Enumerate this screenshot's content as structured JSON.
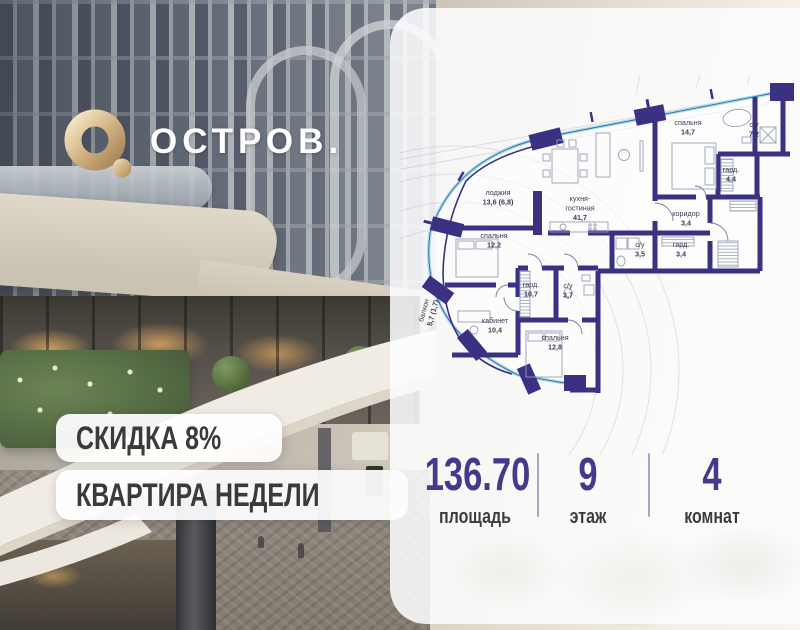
{
  "logo": {
    "brand": "ОСТРОВ.",
    "mark": "О."
  },
  "badges": {
    "discount": "СКИДКА 8%",
    "weekly": "КВАРТИРА НЕДЕЛИ"
  },
  "stats": {
    "area": {
      "value": "136.70",
      "label": "площадь"
    },
    "floor": {
      "value": "9",
      "label": "этаж"
    },
    "rooms": {
      "value": "4",
      "label": "комнат"
    }
  },
  "floor_plan": {
    "rooms": [
      {
        "id": "bedroom-1",
        "name": "спальня",
        "area": "14,7"
      },
      {
        "id": "bath-1",
        "name": "с/у",
        "area": "7,2"
      },
      {
        "id": "wardrobe-1",
        "name": "гард.",
        "area": "4,4"
      },
      {
        "id": "corridor",
        "name": "коридор",
        "area": "3,4"
      },
      {
        "id": "bath-2",
        "name": "с/у",
        "area": "3,5"
      },
      {
        "id": "wardrobe-2",
        "name": "гард.",
        "area": "3,4"
      },
      {
        "id": "kitchen",
        "name": "кухня-гостиная",
        "area": "41,7"
      },
      {
        "id": "loggia",
        "name": "лоджия",
        "area": "13,6 (6,8)"
      },
      {
        "id": "bedroom-2",
        "name": "спальня",
        "area": "12,2"
      },
      {
        "id": "wardrobe-3",
        "name": "гард.",
        "area": "10,7"
      },
      {
        "id": "bath-3",
        "name": "с/у",
        "area": "3,7"
      },
      {
        "id": "office",
        "name": "кабинет",
        "area": "10,4"
      },
      {
        "id": "bedroom-3",
        "name": "спальня",
        "area": "12,8"
      },
      {
        "id": "balcony",
        "name": "балкон",
        "area": "5,7 (1,7)"
      }
    ],
    "colors": {
      "wall": "#3a3182",
      "glazing": "#a8d9ee",
      "glazing_line": "#35689c",
      "label": "#3c3c52"
    }
  },
  "accent_colors": {
    "stat_number": "#46398c",
    "gold": "#c9a77a",
    "badge_text": "#3a3a3a"
  }
}
